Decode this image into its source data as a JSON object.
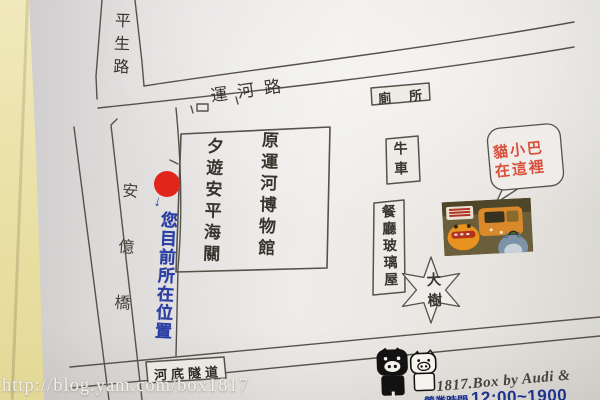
{
  "map": {
    "road_pingsheng": "平生路",
    "road_yunhe": "運河路",
    "bridge_anyi": "安億橋",
    "toilet": "廁所",
    "museum_left": "夕遊安平海關",
    "museum_right": "原運河博物館",
    "ox_cart": "牛車",
    "glass_house": "餐廳玻璃屋",
    "big_tree": "大樹",
    "tunnel": "河底隧道",
    "bubble_line1": "貓小巴",
    "bubble_line2": "在這裡",
    "arrow": "↓",
    "you_are_here": "您目前所在位置"
  },
  "footer": {
    "watermark": "http://blog.yam.com/box1817",
    "credit": "1817.Box by Audi & Ling",
    "hours_prefix": "營業時間",
    "hours": "12:00~1900"
  },
  "colors": {
    "line": "#56524a",
    "red-dot": "#e2251c",
    "ink-blue": "#2b3fa3",
    "bubble-red": "#d9503c",
    "hours-blue": "#1c3490"
  }
}
